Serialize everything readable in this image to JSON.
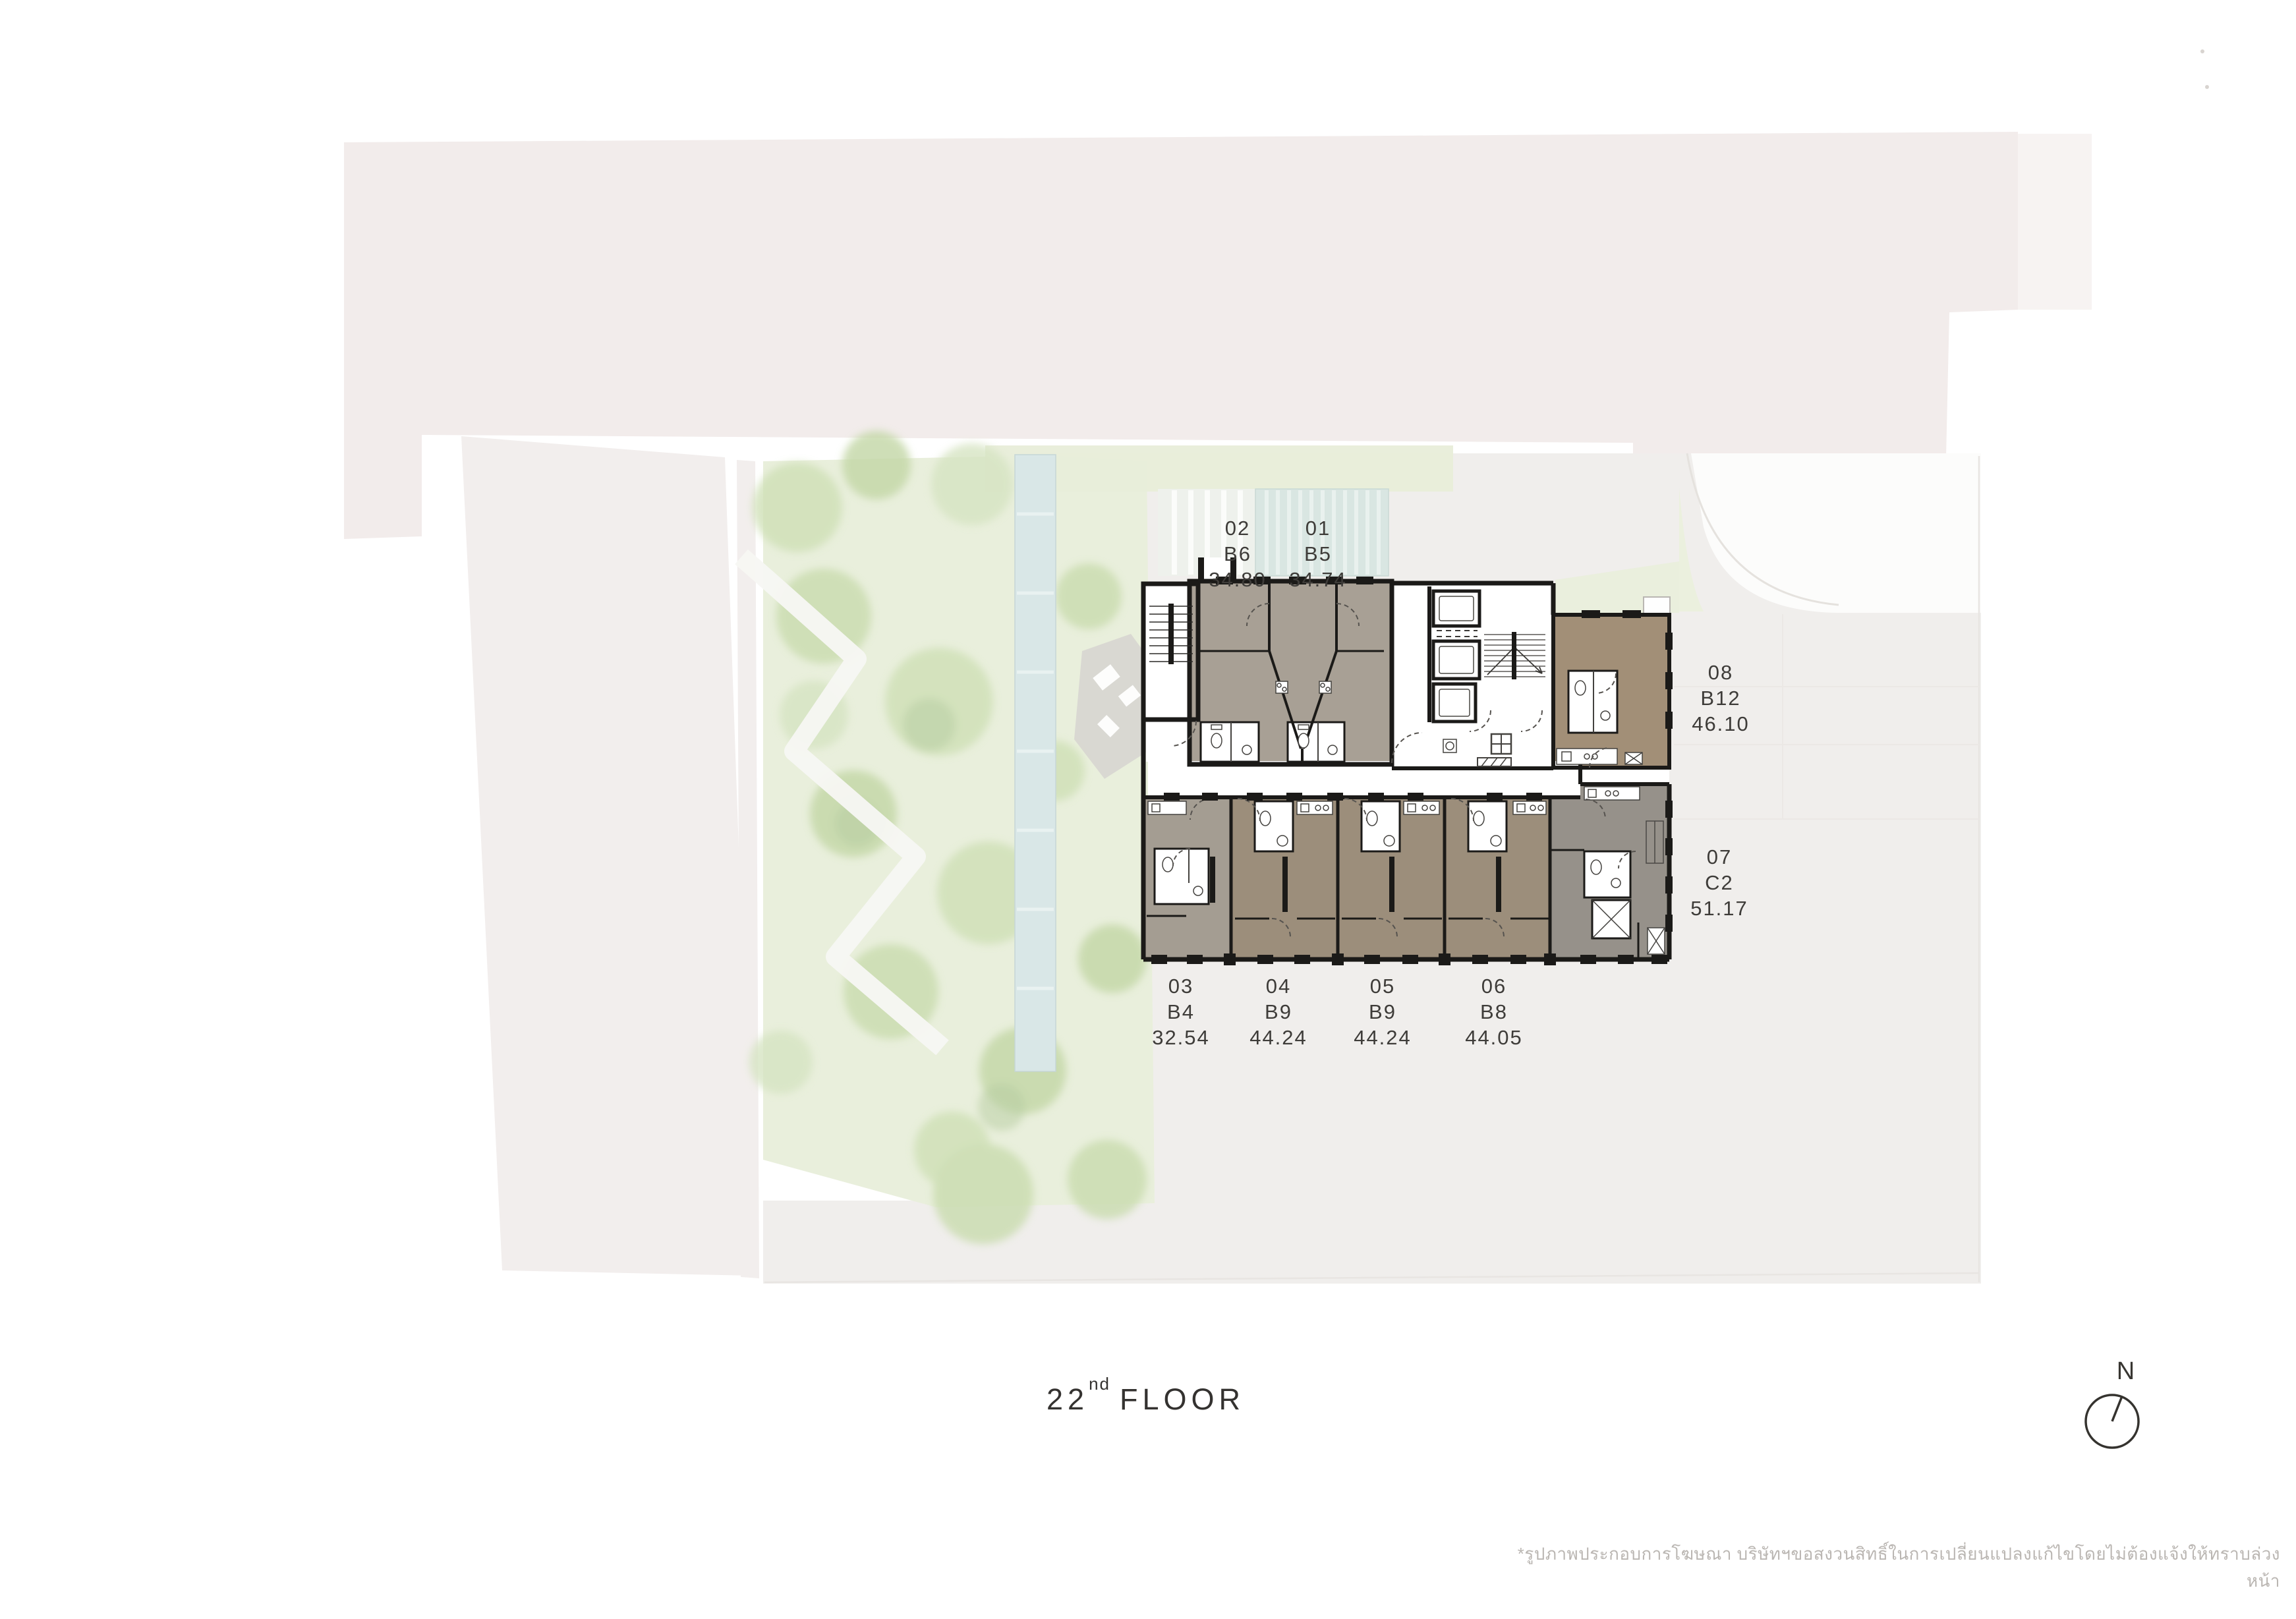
{
  "title": {
    "floor_number": "22",
    "ordinal_suffix": "nd",
    "floor_word": "FLOOR"
  },
  "compass": {
    "north_label": "N"
  },
  "units": [
    {
      "number": "02",
      "type": "B6",
      "area": "34.80"
    },
    {
      "number": "01",
      "type": "B5",
      "area": "34.74"
    },
    {
      "number": "08",
      "type": "B12",
      "area": "46.10"
    },
    {
      "number": "07",
      "type": "C2",
      "area": "51.17"
    },
    {
      "number": "03",
      "type": "B4",
      "area": "32.54"
    },
    {
      "number": "04",
      "type": "B9",
      "area": "44.24"
    },
    {
      "number": "05",
      "type": "B9",
      "area": "44.24"
    },
    {
      "number": "06",
      "type": "B8",
      "area": "44.05"
    }
  ],
  "disclaimer": "*รูปภาพประกอบการโฆษณา บริษัทฯขอสงวนสิทธิ์ในการเปลี่ยนแปลงแก้ไขโดยไม่ต้องแจ้งให้ทราบล่วงหน้า",
  "colors": {
    "wall": "#1b1a18",
    "unit_01_02_fill": "#a8a095",
    "unit_08_fill": "#a28f77",
    "unit_04_05_06_fill": "#9c8e7b",
    "unit_03_fill": "#a49d92",
    "unit_07_fill": "#96918a",
    "site_band_pink": "#f2eceb",
    "garden_green": "#e9efdc",
    "pool_blue": "#d9e7e7",
    "ground_gray": "#f0eeec",
    "label_text": "#3e3c39",
    "disclaimer_text": "#bab6b2"
  }
}
